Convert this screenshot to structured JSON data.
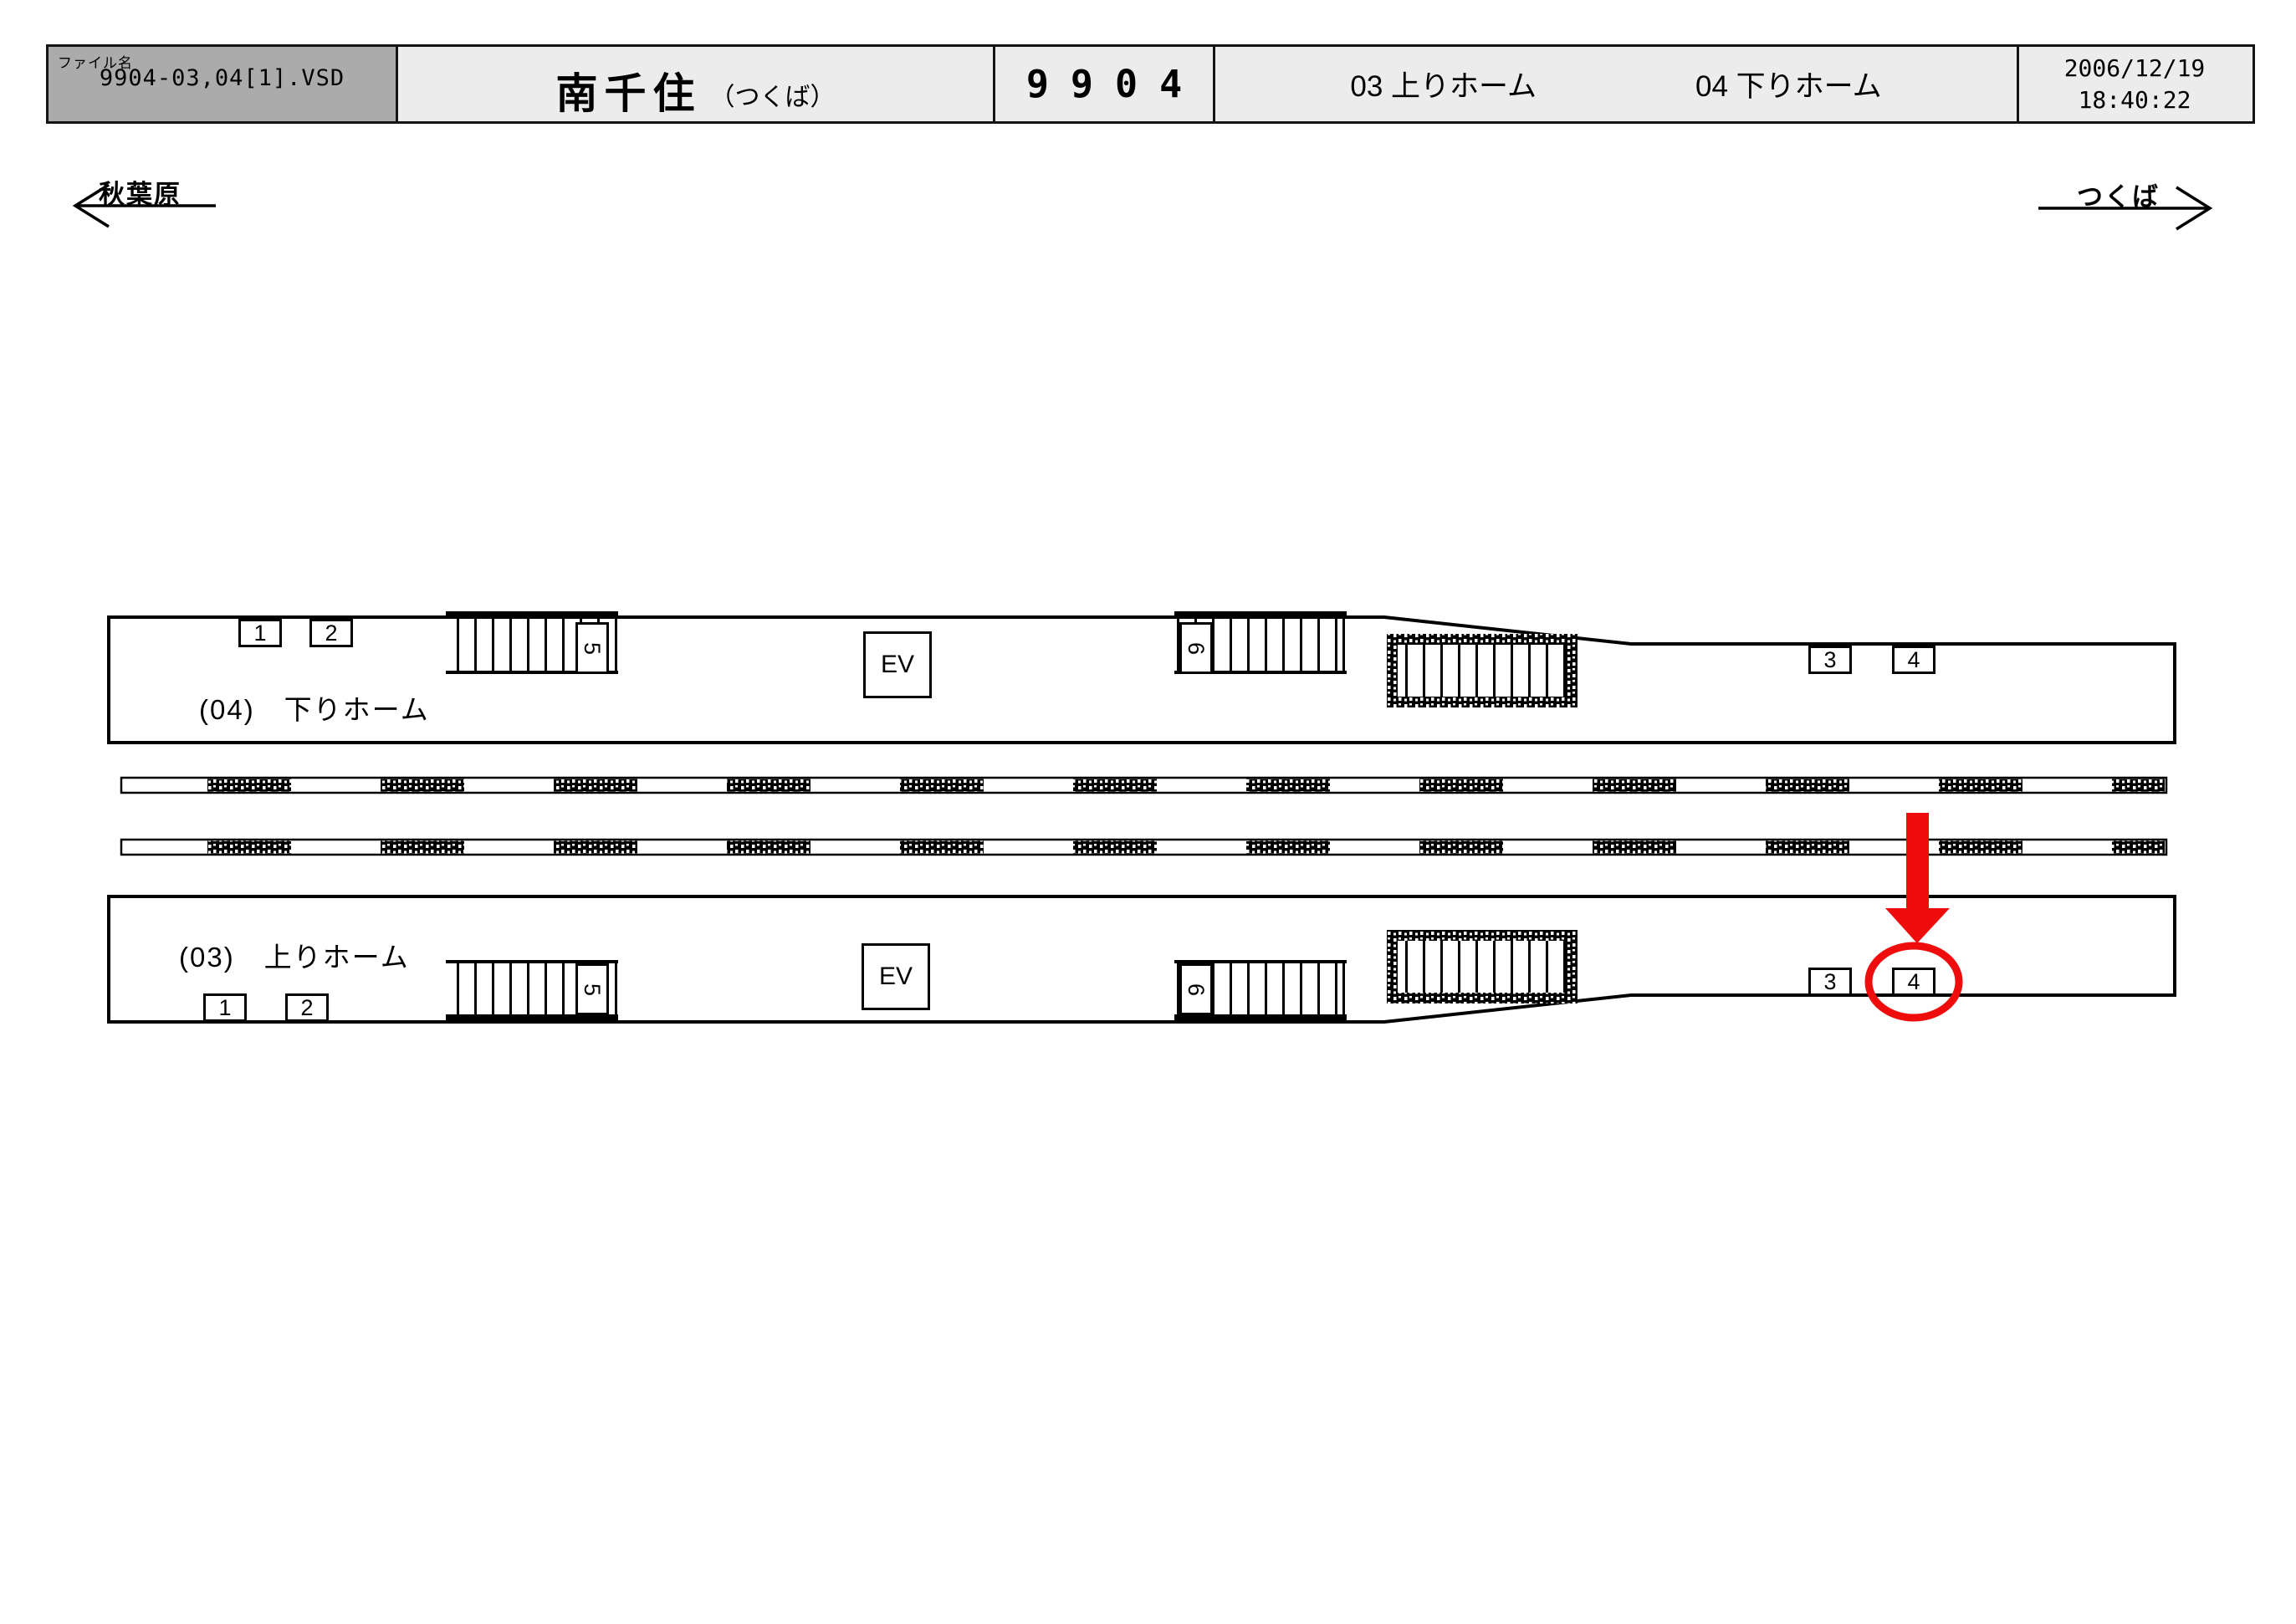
{
  "header": {
    "file_label": "ファイル名",
    "file_name": "9904-03,04[1].VSD",
    "station_name": "南千住",
    "station_note": "（つくば）",
    "sheet_number": "9904",
    "platform_03_label": "03 上りホーム",
    "platform_04_label": "04 下りホーム",
    "date": "2006/12/19",
    "time": "18:40:22"
  },
  "directions": {
    "left": "秋葉原",
    "right": "つくば"
  },
  "platforms": {
    "upper": {
      "label": "(04)　下りホーム",
      "markers": [
        "1",
        "2",
        "3",
        "4"
      ],
      "elevator": "EV",
      "stair_a": "5",
      "stair_b": "6"
    },
    "lower": {
      "label": "(03)　上りホーム",
      "markers": [
        "1",
        "2",
        "3",
        "4"
      ],
      "elevator": "EV",
      "stair_a": "5",
      "stair_b": "6"
    }
  },
  "annotation": {
    "highlight_color": "#ee0c0c",
    "highlighted_marker": "4",
    "highlighted_platform": "lower"
  }
}
